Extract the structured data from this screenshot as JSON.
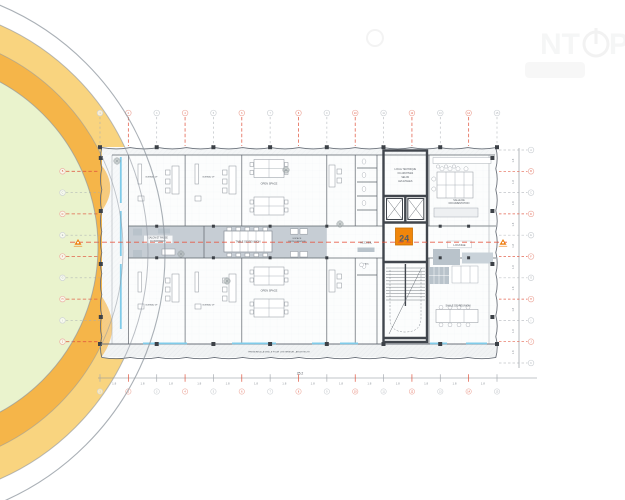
{
  "floor_plan": {
    "level_badge": "24",
    "rooms": {
      "office_label": "BUREAU 2P",
      "open_space_top": "OPEN SPACE",
      "open_space_bottom": "OPEN SPACE",
      "local_technique_lines": [
        "LOCAL TECHNIQUE",
        "OU ARCHIVES",
        "SELON",
        "LES ETAGES"
      ],
      "documentation_lines": [
        "SALLE DE",
        "DOCUMENTATION"
      ],
      "salon_lines": [
        "SALON ET PAUSE",
        "DU BATIMENT"
      ],
      "table_reunion": "TABLE DE REUNION",
      "repro_lines": [
        "ESPACE",
        "REPROGRAPHIE"
      ],
      "accueil": "ACCUEIL",
      "lounge": "LOUNGE",
      "salle_reunion": "SALLE DE REUNION",
      "asc": "ASC"
    },
    "note": "PRENDRE A LA GRILLE POUR L'EXTERIEUR - ARCHITECTE",
    "dimensions": {
      "bay": "1.8",
      "total_width": "25.2"
    },
    "axes": {
      "columns": [
        "1",
        "2",
        "3",
        "4",
        "5",
        "6",
        "7",
        "8",
        "9",
        "10",
        "11",
        "12",
        "13",
        "14",
        "15"
      ],
      "rows": [
        "A",
        "B",
        "C",
        "D",
        "E",
        "F",
        "G",
        "H",
        "I",
        "J",
        "K"
      ]
    },
    "watermark": {
      "part1": "NT",
      "part2": "PL"
    },
    "colors": {
      "accent_orange": "#f0860a",
      "grid_red": "#e8503a",
      "glazing_blue": "#7fcbe9",
      "ring_yellow": "#f9d47f",
      "ring_orange": "#f5b549",
      "circle_green": "#eaf3cd"
    }
  }
}
